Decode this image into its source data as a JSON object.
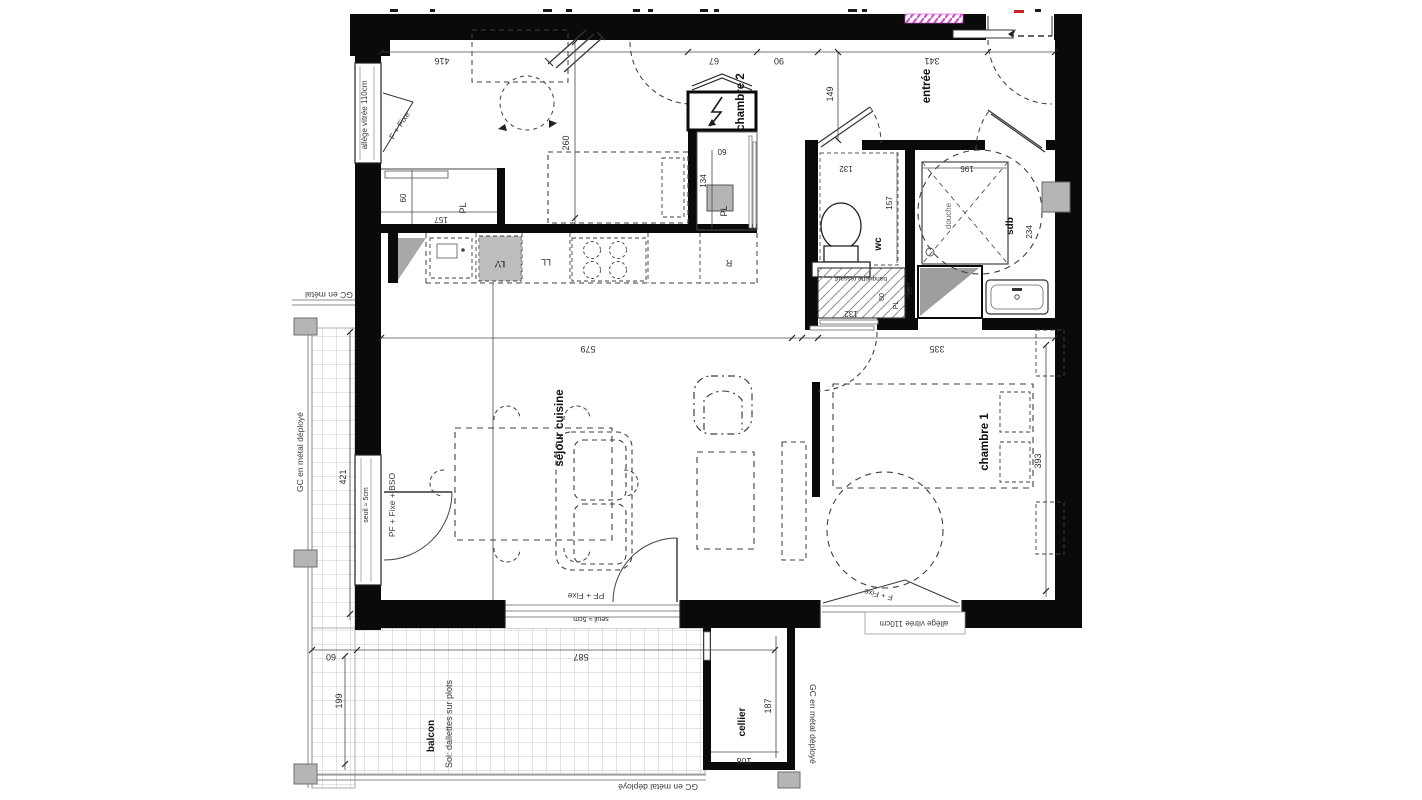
{
  "plan": {
    "rooms": {
      "chambre2": "chambre 2",
      "chambre1": "chambre 1",
      "entree": "entrée",
      "wc": "wc",
      "sdb": "sdb",
      "douche": "douche",
      "sejour": "séjour cuisine",
      "balcon": "balcon",
      "cellier": "cellier"
    },
    "annotations": {
      "allege_left": "allège vitrée 110cm",
      "allege_bottom": "allège vitrée 110cm",
      "f_fixe_left": "F + Fixe",
      "f_fixe_bottom": "F + Fixe",
      "pf_fixe_bottom": "PF + Fixe",
      "pf_fixe_bso": "PF + Fixe + BSO",
      "seuil_left": "seuil ≈ 5cm",
      "seuil_bottom": "seuil ≈ 5cm",
      "gc_metal": "GC en métal",
      "gc_deploye_left": "GC en métal déployé",
      "gc_deploye_right": "GC en métal déployé",
      "gc_deploye_bottom": "GC en métal déployé",
      "sol_dallettes": "Sol: dallettes sur plots",
      "banquette": "banquette ressaut"
    },
    "appliances": {
      "lv": "LV",
      "ll": "LL",
      "fridge": "R",
      "pl_chambre2": "PL",
      "pl_entree": "PL",
      "pl_hatch": "PL"
    },
    "dims": {
      "d416": "416",
      "d67": "67",
      "d90": "90",
      "d341": "341",
      "d149": "149",
      "d260": "260",
      "d60_closet": "60",
      "d157_closet": "157",
      "d60_pl": "60",
      "d134": "134",
      "d132_wc": "132",
      "d157_wc": "157",
      "d195": "195",
      "d234": "234",
      "d579": "579",
      "d335": "335",
      "d393": "393",
      "d421": "421",
      "d132_hatch": "132",
      "d60_hatch": "60",
      "d25": "25",
      "d60_balcon": "60",
      "d199": "199",
      "d587": "587",
      "d187": "187",
      "d108": "108"
    },
    "colors": {
      "wall": "#0a0a0a",
      "gray_fill": "#b5b5b5",
      "hatch_pink": "#d44fd0",
      "mark_red": "#cc2222"
    }
  }
}
